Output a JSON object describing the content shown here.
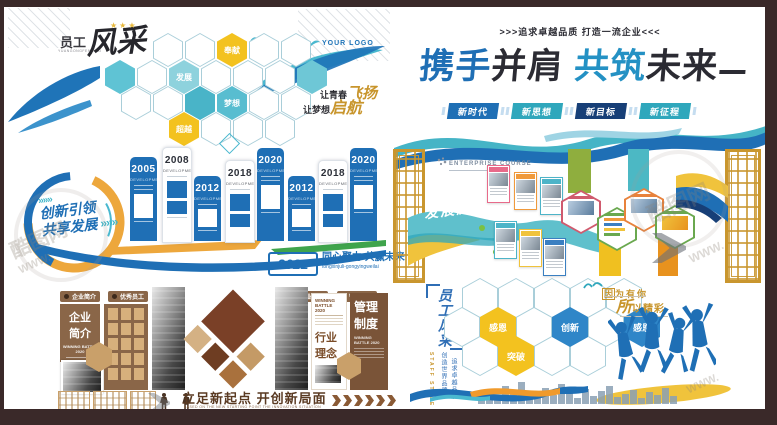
{
  "accent_colors": {
    "blue": "#1f6fb5",
    "teal": "#2fa7bc",
    "navy": "#173f77",
    "yellow": "#f3c21f",
    "gold": "#c8952c",
    "brown": "#8a6648",
    "dark_brown": "#6e4226",
    "green": "#3fa44c"
  },
  "watermark": {
    "site": "酷图网",
    "www": "WWW."
  },
  "staff_wall": {
    "title_prefix": "员工",
    "title_pinyin": "YUANGONGFENGCAI",
    "title_main": "风采",
    "stars": "★★★",
    "logo_text": "YOUR LOGO",
    "hex_words": [
      {
        "label": "奉献",
        "color": "#f3c21f"
      },
      {
        "label": "发展",
        "color": "#8ed2dd"
      },
      {
        "label": "梦想",
        "color": "#58bdd0"
      },
      {
        "label": "超越",
        "color": "#f3c21f"
      }
    ],
    "slogan1_prefix": "让青春",
    "slogan1_script": "飞扬",
    "slogan2_prefix": "让梦想",
    "slogan2_script": "启航"
  },
  "banner": {
    "eyebrow": ">>>追求卓越品质 打造一流企业<<<",
    "title_seg1": "携手",
    "title_seg2": "并肩",
    "title_seg3": "共筑",
    "title_seg4": "未来",
    "badges": [
      {
        "label": "新时代",
        "color": "#1f6fb5"
      },
      {
        "label": "新思想",
        "color": "#2fa7bc"
      },
      {
        "label": "新目标",
        "color": "#173f77"
      },
      {
        "label": "新征程",
        "color": "#2fa7bc"
      }
    ]
  },
  "timeline": {
    "arrows": "»»»",
    "circle_line1": "创新引领",
    "circle_line2": "共享发展",
    "dev_label": "DEVELOPMENT",
    "columns": [
      {
        "year": "2005"
      },
      {
        "year": "2008"
      },
      {
        "year": "2012"
      },
      {
        "year": "2018"
      },
      {
        "year": "2020"
      },
      {
        "year": "2012"
      },
      {
        "year": "2018"
      },
      {
        "year": "2020"
      }
    ],
    "badge_year": "2022",
    "slogan": "同心聚力 共赢未来",
    "slogan_pinyin": "tongxinjuli-gongyingweilai"
  },
  "course": {
    "eyebrow": "ENTERPRISE COURSE",
    "title": "发展历程"
  },
  "brown_wall": {
    "tabs": [
      "企业简介",
      "优秀员工",
      "行业理念",
      "管理制度"
    ],
    "panel1_line1": "企业",
    "panel1_line2": "简介",
    "winning_label": "WINNING BATTLE 2020",
    "industry_line1": "行业",
    "industry_line2": "理念",
    "mgmt_line1": "管理",
    "mgmt_line2": "制度",
    "footer_slogan": "立足新起点  开创新局面",
    "footer_sub": "BASED ON THE NEW STARTING POINT THE INNOVATION SITUATION"
  },
  "style_wall": {
    "title_vertical": "员工风采",
    "sub_vertical": "STAFF STYLE",
    "slogan_v1": "创造世界品牌",
    "slogan_v2": "追求卓越品质",
    "hex_words": [
      {
        "label": "感恩",
        "color": "#f3c21f"
      },
      {
        "label": "突破",
        "color": "#f3c21f"
      },
      {
        "label": "创新",
        "color": "#2f86c8"
      },
      {
        "label": "感恩",
        "color": "#2f86c8"
      }
    ],
    "right_seg1_boxed": "因",
    "right_seg1_rest": "为有你",
    "right_seg2_big": "所",
    "right_seg2_rest": "以精彩"
  }
}
